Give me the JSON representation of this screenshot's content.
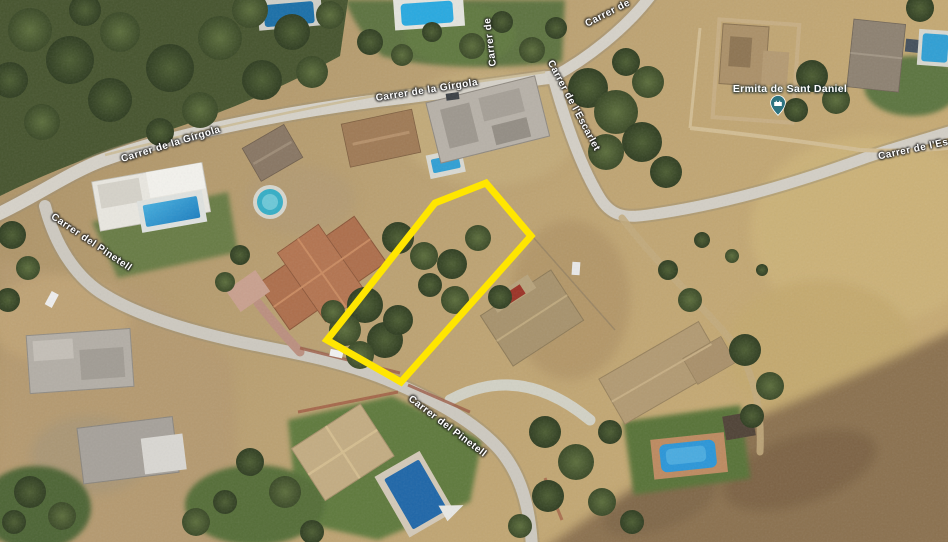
{
  "map": {
    "view": "satellite-aerial",
    "road_labels": {
      "girgola_west": "Carrer de la Gírgola",
      "girgola_center": "Carrer de la Gírgola",
      "top_edge_partial": "Carrer de",
      "vertical_partial": "Carrer de",
      "escarlet_vertical": "Carrer de l'Escarlet",
      "escarlet_east": "Carrer de l'Escarlet",
      "pinetell_west": "Carrer del Pinetell",
      "pinetell_south": "Carrer del Pinetell"
    },
    "poi": {
      "name": "Ermita de Sant Daniel",
      "pin_icon": "historic-building-pin",
      "pin_color": "#2d7380"
    },
    "parcel": {
      "outline_color": "#ffe600",
      "stroke_width": 7,
      "points": "435,203 486,183 531,236 401,382 327,340"
    },
    "palette": {
      "scrub": "#b89b6c",
      "forest": "#46542e",
      "road": "#d6d2c9",
      "lawn": "#5f7a3e",
      "pool": "#2b9cd8",
      "dark_slope": "#8b7150"
    }
  }
}
